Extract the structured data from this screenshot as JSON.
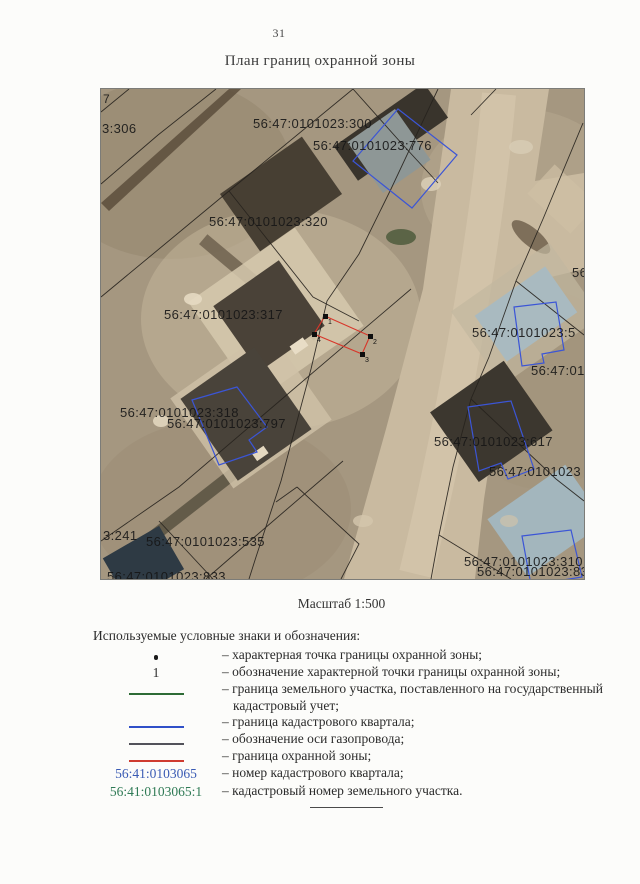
{
  "page": {
    "number": "31",
    "title": "План границ охранной зоны",
    "scale_label": "Масштаб 1:500"
  },
  "map": {
    "labels": [
      {
        "text": "7",
        "x": 2,
        "y": 4,
        "small": true
      },
      {
        "text": "3:306",
        "x": 1,
        "y": 33
      },
      {
        "text": "56:47:0101023:300",
        "x": 152,
        "y": 28
      },
      {
        "text": "56:47:0101023:776",
        "x": 212,
        "y": 50
      },
      {
        "text": "56:47:0101023:320",
        "x": 108,
        "y": 126
      },
      {
        "text": "56:47:0101023:317",
        "x": 63,
        "y": 219
      },
      {
        "text": "56:47:0101023:318",
        "x": 19,
        "y": 317
      },
      {
        "text": "56:47:0101023:797",
        "x": 66,
        "y": 328
      },
      {
        "text": "56",
        "x": 471,
        "y": 177
      },
      {
        "text": "56:47:0101023:5",
        "x": 371,
        "y": 237
      },
      {
        "text": "56:47:01",
        "x": 430,
        "y": 275
      },
      {
        "text": "56:47:0101023:617",
        "x": 333,
        "y": 346
      },
      {
        "text": "56:47:0101023",
        "x": 388,
        "y": 376
      },
      {
        "text": "3:241",
        "x": 2,
        "y": 440
      },
      {
        "text": "56:47:0101023:535",
        "x": 45,
        "y": 446
      },
      {
        "text": "56:47:0101023:833",
        "x": 6,
        "y": 481
      },
      {
        "text": "56:47:0101023:310",
        "x": 363,
        "y": 466
      },
      {
        "text": "56:47:0101023:83",
        "x": 376,
        "y": 476
      }
    ],
    "points": [
      {
        "n": "1",
        "x": 224,
        "y": 227
      },
      {
        "n": "2",
        "x": 269,
        "y": 247
      },
      {
        "n": "3",
        "x": 261,
        "y": 265
      },
      {
        "n": "4",
        "x": 213,
        "y": 245
      }
    ]
  },
  "legend": {
    "header": "Используемые условные знаки и обозначения:",
    "rows": [
      {
        "symbol_type": "dot",
        "text": "– характерная точка границы охранной зоны;"
      },
      {
        "symbol_type": "digit",
        "symbol_text": "1",
        "text": "– обозначение характерной точки границы охранной зоны;"
      },
      {
        "symbol_type": "line",
        "color": "#2d6b35",
        "text": "– граница земельного участка, поставленного на государственный кадастровый учет;"
      },
      {
        "symbol_type": "line",
        "color": "#3050c8",
        "text": "– граница кадастрового квартала;"
      },
      {
        "symbol_type": "line",
        "color": "#52525a",
        "text": "– обозначение оси газопровода;"
      },
      {
        "symbol_type": "line",
        "color": "#cf3b2f",
        "text": "– граница охранной зоны;"
      },
      {
        "symbol_type": "text",
        "symbol_text": "56:41:0103065",
        "symbol_color": "#3a5bb4",
        "text": "– номер кадастрового квартала;"
      },
      {
        "symbol_type": "text",
        "symbol_text": "56:41:0103065:1",
        "symbol_color": "#2f7a55",
        "text": "– кадастровый номер земельного участка."
      }
    ]
  },
  "colors": {
    "protection_zone": "#d8362a",
    "cadastral_outline": "#3b55d6",
    "parcel_line": "#26221d"
  }
}
